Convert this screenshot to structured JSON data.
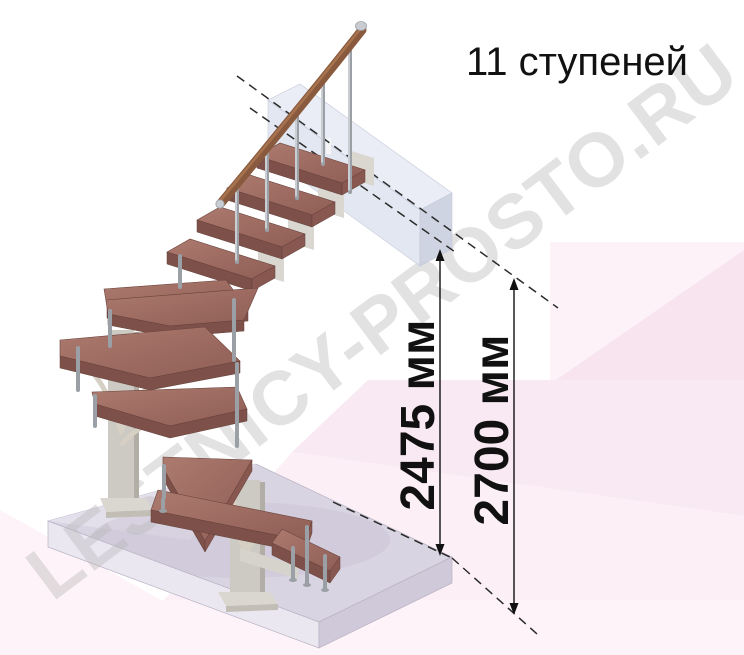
{
  "title": "11 ступеней",
  "steps_count": 11,
  "watermark": "LESTNICY-PROSTO.RU",
  "dims": {
    "d1": "2475 мм",
    "d2": "2700 мм"
  },
  "illustration": {
    "subject": "modular winder staircase with 11 wooden treads, chrome balusters, wooden handrail, upper landing slab and base floor slab",
    "icons": [
      "up-arrow-icon",
      "down-arrow-icon",
      "dashed-reference-line"
    ]
  },
  "colors": {
    "background": "#ffffff",
    "pink_light": "#fdf2f8",
    "pink_mid": "#f9e9f2",
    "pink_deep": "#f7e4ee",
    "wood_top": "#a9766b",
    "wood_front": "#7d5149",
    "rail_brown": "#8a5a3e",
    "chrome": "#9aa0a6",
    "column_gray": "#cdc9c3",
    "base_slab_top": "#d9d4e2",
    "landing_slab": "#dfe3ef",
    "dimension_text": "#111111",
    "watermark_gray": "#b9b9b9"
  }
}
